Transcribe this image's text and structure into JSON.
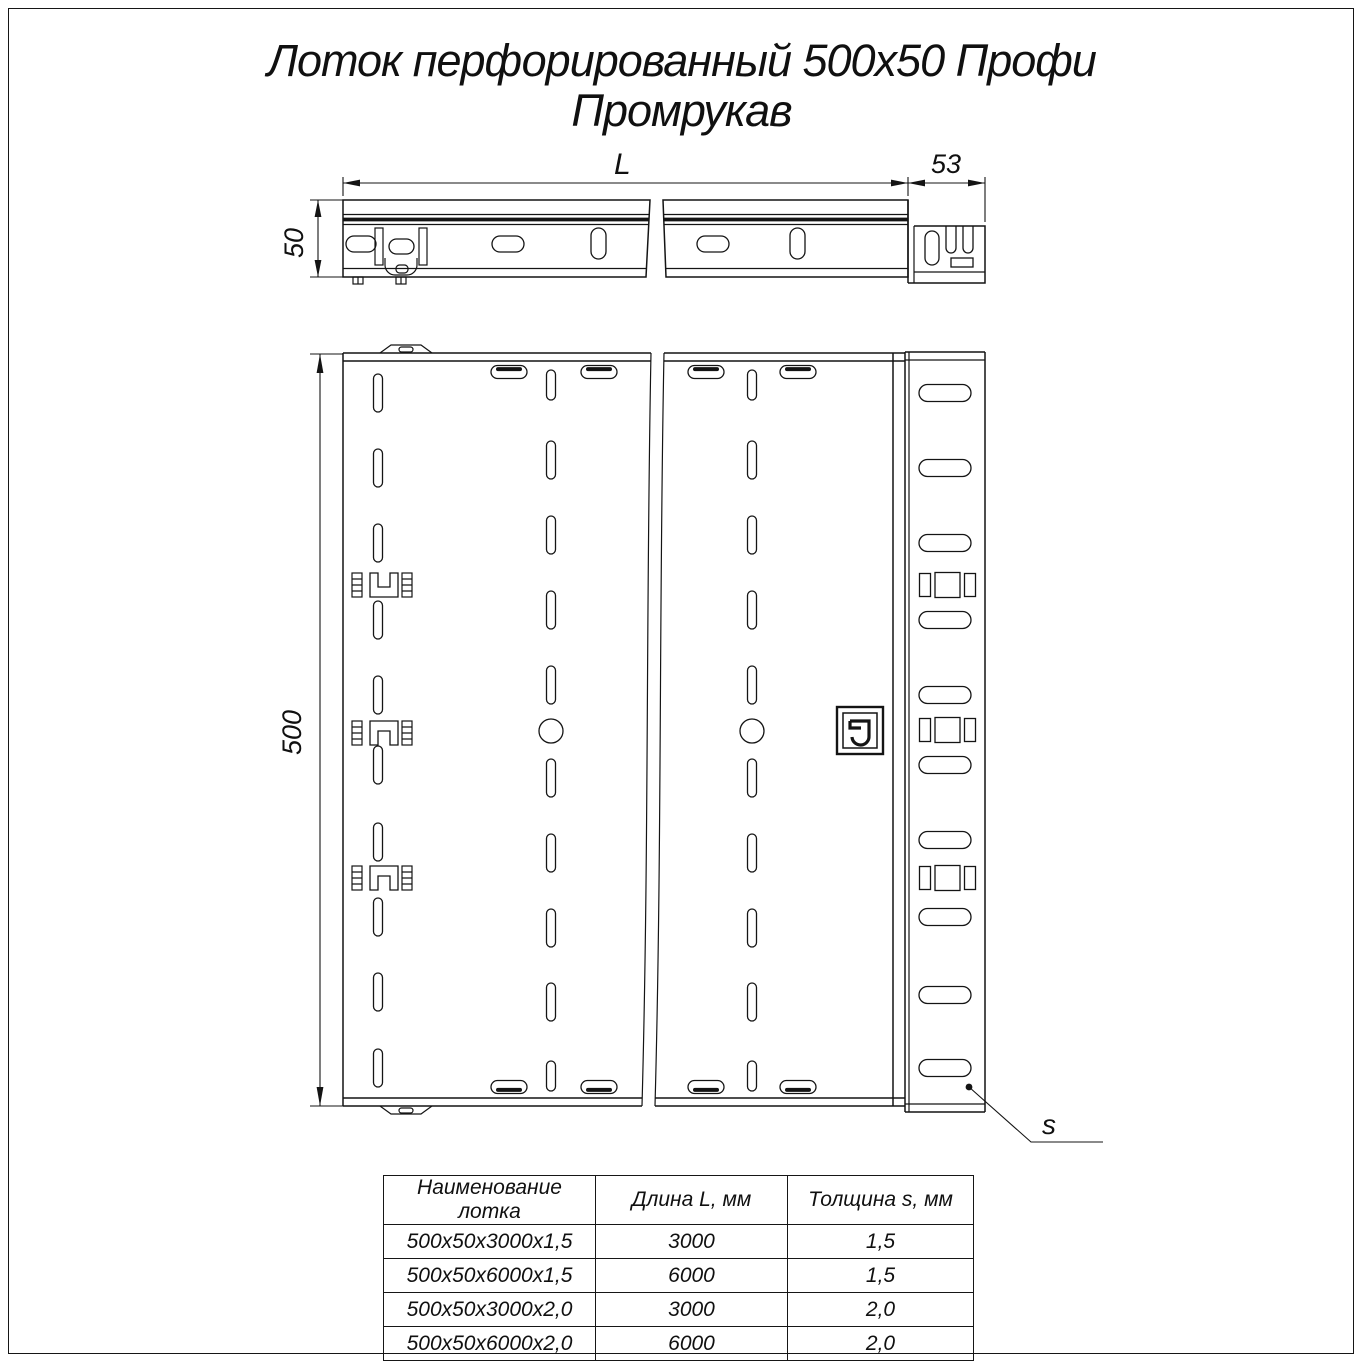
{
  "title": {
    "line1": "Лоток перфорированный 500x50 Профи",
    "line2": "Промрукав"
  },
  "dimensions": {
    "length_label": "L",
    "end_width": "53",
    "height": "50",
    "width": "500",
    "thickness_label": "s"
  },
  "logo": {
    "name": "promrukav-logo"
  },
  "table": {
    "headers": [
      "Наименование лотка",
      "Длина L, мм",
      "Толщина s, мм"
    ],
    "rows": [
      [
        "500x50x3000x1,5",
        "3000",
        "1,5"
      ],
      [
        "500x50x6000x1,5",
        "6000",
        "1,5"
      ],
      [
        "500x50x3000x2,0",
        "3000",
        "2,0"
      ],
      [
        "500x50x6000x2,0",
        "6000",
        "2,0"
      ]
    ]
  }
}
